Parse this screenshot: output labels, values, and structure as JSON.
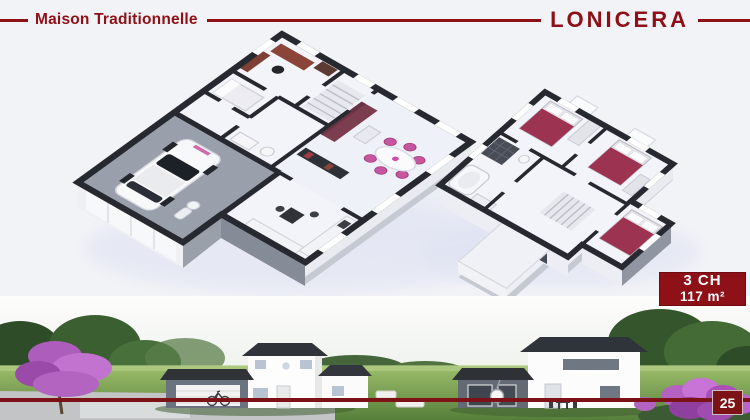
{
  "header": {
    "collection": "Maison Traditionnelle",
    "model": "LONICERA"
  },
  "spec_badge": {
    "bedrooms": "3 CH",
    "area": "117 m²"
  },
  "page": {
    "number": "25"
  },
  "plans": {
    "ground_floor": "ground-floor-plan",
    "first_floor": "first-floor-plan"
  },
  "colors": {
    "accent_red": "#8e1016",
    "badge_red": "#8e1118",
    "separator_red": "#7c1216",
    "wall_dark": "#26292f",
    "floor_light": "#f3f4fa",
    "garage_floor": "#9aa0ab",
    "sofa_maroon": "#7c3d51",
    "bed_maroon": "#9c3350",
    "chair_pink": "#c6569f",
    "grass_green": "#6f9c4c",
    "blossom_purple": "#b264c0"
  }
}
